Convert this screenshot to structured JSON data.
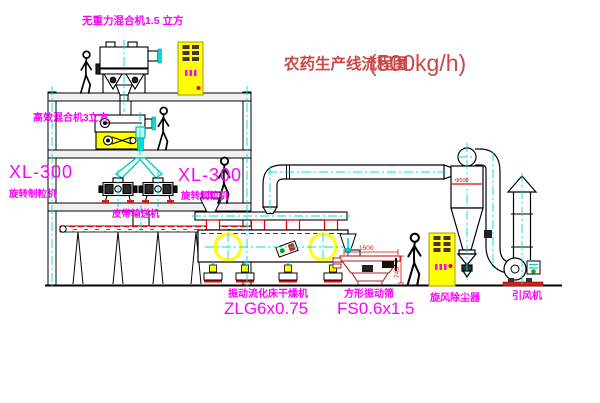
{
  "diagram": {
    "title": {
      "name_cn": "农药生产线流程图",
      "capacity": "(500kg/h)"
    },
    "equipment_labels": {
      "top_mixer": "无重力混合机1.5 立方",
      "second_mixer": "高效混合机3立方",
      "granulator_left": {
        "model": "XL-300",
        "name": "旋转制粒机"
      },
      "granulator_right": {
        "model": "XL-300",
        "name": "旋转制粒机"
      },
      "belt_conveyor": "皮带输送机",
      "fluid_bed_dryer": {
        "name": "振动流化床干燥机",
        "model": "ZLG6x0.75"
      },
      "vibrating_sieve": {
        "name": "方形振动筛",
        "model": "FS0.6x1.5"
      },
      "cyclone": "旋风除尘器",
      "induced_draft_fan": "引风机"
    },
    "dimensions": {
      "sieve_length": "1500",
      "sieve_height": "745",
      "cyclone_diameter": "Φ500"
    },
    "colors": {
      "background": "#ffffff",
      "line_black": "#000000",
      "label_magenta": "#ff00ff",
      "title_red": "#cc4747",
      "dimension_red": "#ee0000",
      "equipment_yellow": "#ffff00",
      "centerline_cyan": "#00dcdc",
      "conveyor_green": "#00aa00"
    }
  }
}
